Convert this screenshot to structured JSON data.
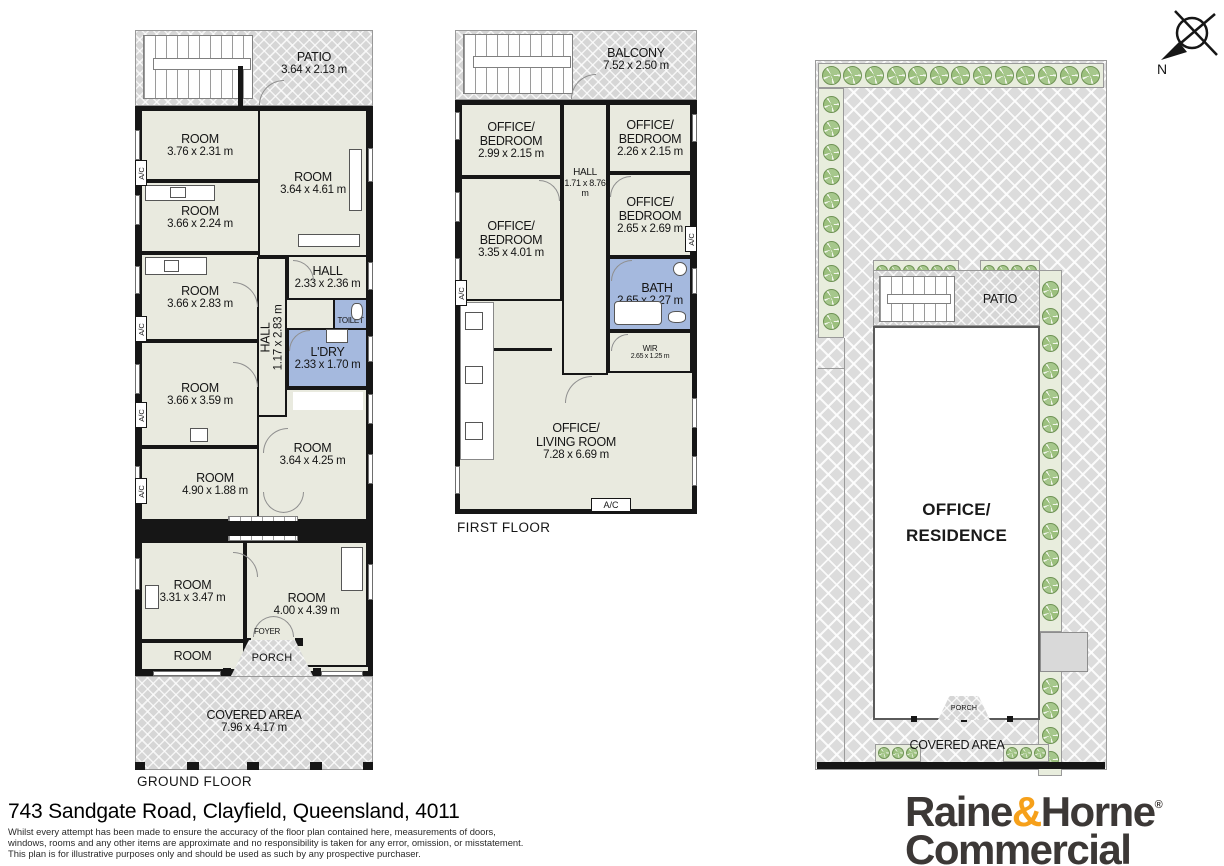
{
  "compass": {
    "north": "N"
  },
  "common": {
    "ac": "A/C"
  },
  "gf": {
    "label": "GROUND FLOOR",
    "rooms": [
      {
        "n1": "PATIO",
        "d": "3.64 x 2.13 m"
      },
      {
        "n1": "ROOM",
        "d": "3.76 x 2.31 m"
      },
      {
        "n1": "ROOM",
        "d": "3.64 x 4.61 m"
      },
      {
        "n1": "ROOM",
        "d": "3.66 x 2.24 m"
      },
      {
        "n1": "ROOM",
        "d": "3.66 x 2.83 m"
      },
      {
        "n1": "HALL",
        "d": "2.33 x 2.36 m"
      },
      {
        "n1": "TOILET"
      },
      {
        "n1": "L'DRY",
        "d": "2.33 x 1.70 m"
      },
      {
        "n1": "HALL",
        "d": "1.17 x 2.83 m"
      },
      {
        "n1": "ROOM",
        "d": "3.66 x 3.59 m"
      },
      {
        "n1": "ROOM",
        "d": "3.64 x 4.25 m"
      },
      {
        "n1": "ROOM",
        "d": "4.90 x 1.88 m"
      },
      {
        "n1": "ROOM",
        "d": "3.31 x 3.47 m"
      },
      {
        "n1": "ROOM",
        "d": "4.00 x 4.39 m"
      },
      {
        "n1": "ROOM"
      },
      {
        "n1": "FOYER"
      },
      {
        "n1": "PORCH"
      },
      {
        "n1": "COVERED AREA",
        "d": "7.96 x 4.17 m"
      }
    ]
  },
  "ff": {
    "label": "FIRST FLOOR",
    "rooms": [
      {
        "n1": "BALCONY",
        "d": "7.52 x 2.50 m"
      },
      {
        "n1": "OFFICE/",
        "n2": "BEDROOM",
        "d": "2.99 x 2.15 m"
      },
      {
        "n1": "HALL",
        "d": "1.71 x 8.76 m"
      },
      {
        "n1": "OFFICE/",
        "n2": "BEDROOM",
        "d": "2.26 x 2.15 m"
      },
      {
        "n1": "OFFICE/",
        "n2": "BEDROOM",
        "d": "3.35 x 4.01 m"
      },
      {
        "n1": "OFFICE/",
        "n2": "BEDROOM",
        "d": "2.65 x 2.69 m"
      },
      {
        "n1": "BATH",
        "d": "2.65 x 2.27 m"
      },
      {
        "n1": "WIR",
        "d": "2.65 x 1.25 m"
      },
      {
        "n1": "OFFICE/",
        "n2": "LIVING ROOM",
        "d": "7.28 x 6.69 m"
      }
    ]
  },
  "site": {
    "patio": "PATIO",
    "building1": "OFFICE/",
    "building2": "RESIDENCE",
    "porch": "PORCH",
    "covered": "COVERED AREA"
  },
  "footer": {
    "address": "743 Sandgate Road, Clayfield, Queensland, 4011",
    "disclaimer": [
      "Whilst every attempt has been made to ensure the accuracy of the floor plan contained here, measurements of doors,",
      "windows, rooms and any other items are approximate and no responsibility is taken for any error, omission, or misstatement.",
      "This plan is for illustrative purposes only and should be used as such by any prospective purchaser."
    ]
  },
  "brand": {
    "word1": "Raine",
    "amp": "&",
    "word2": "Horne",
    "reg": "®",
    "line2": "Commercial"
  }
}
